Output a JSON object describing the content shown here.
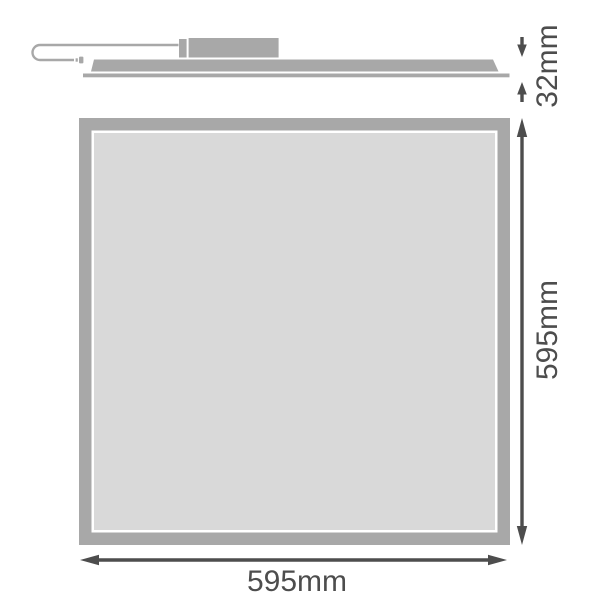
{
  "colors": {
    "panel_gray": "#a8a8a8",
    "panel_face": "#d9d9d9",
    "face_outline": "#ffffff",
    "dimension_line": "#4d4d4d",
    "background": "#ffffff"
  },
  "side_view": {
    "depth_dimension": {
      "label": "32mm"
    }
  },
  "front_view": {
    "height_dimension": {
      "label": "595mm"
    },
    "width_dimension": {
      "label": "595mm"
    }
  }
}
